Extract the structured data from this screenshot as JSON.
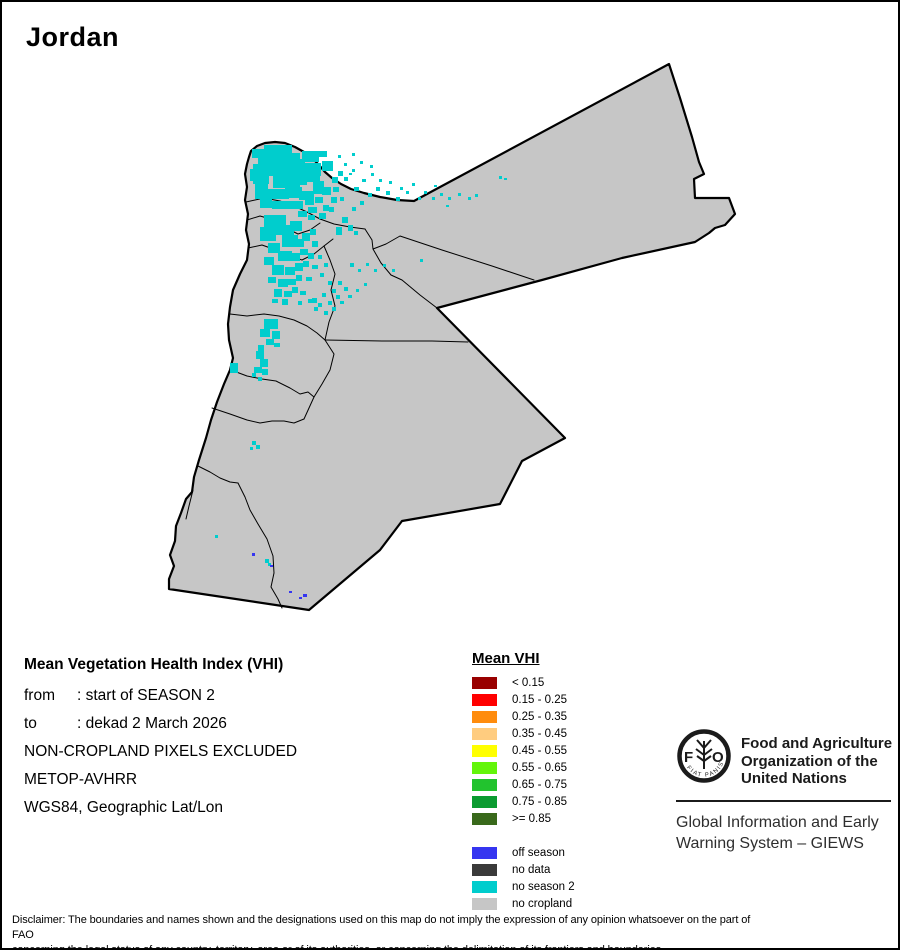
{
  "title": "Jordan",
  "colors": {
    "background": "#FFFFFF",
    "frame": "#000000",
    "land_no_cropland": "#C6C6C6",
    "boundary": "#000000"
  },
  "info": {
    "title": "Mean Vegetation Health Index (VHI)",
    "rows": [
      {
        "label": "from",
        "value": ": start of SEASON 2"
      },
      {
        "label": "to",
        "value": ": dekad 2 March 2026"
      }
    ],
    "lines": [
      "NON-CROPLAND PIXELS EXCLUDED",
      "METOP-AVHRR",
      "WGS84, Geographic Lat/Lon"
    ]
  },
  "legend": {
    "title": "Mean VHI",
    "vhi_classes": [
      {
        "label": "< 0.15",
        "color": "#990000"
      },
      {
        "label": "0.15 - 0.25",
        "color": "#FF0000"
      },
      {
        "label": "0.25 - 0.35",
        "color": "#FF8C0D"
      },
      {
        "label": "0.35 - 0.45",
        "color": "#FFCC7F"
      },
      {
        "label": "0.45 - 0.55",
        "color": "#FFFF00"
      },
      {
        "label": "0.55 - 0.65",
        "color": "#63F50A"
      },
      {
        "label": "0.65 - 0.75",
        "color": "#22C32E"
      },
      {
        "label": "0.75 - 0.85",
        "color": "#0B9B30"
      },
      {
        "label": ">= 0.85",
        "color": "#39691B"
      }
    ],
    "status_classes": [
      {
        "label": "off season",
        "color": "#3535F0"
      },
      {
        "label": "no data",
        "color": "#3A3A3A"
      },
      {
        "label": "no season 2",
        "color": "#00CDCD"
      },
      {
        "label": "no cropland",
        "color": "#C6C6C6"
      }
    ]
  },
  "fao": {
    "org_lines": [
      "Food and Agriculture",
      "Organization of the",
      "United Nations"
    ],
    "giews_lines": [
      "Global Information and Early",
      "Warning System – GIEWS"
    ],
    "logo": {
      "letter_f": "F",
      "letter_o": "O",
      "motto": "FIAT PANIS"
    }
  },
  "disclaimer": {
    "lines": [
      "Disclaimer: The boundaries and names shown and the designations used on this map do not imply the expression of any opinion whatsoever on the part of FAO",
      "concerning the legal status of any country, territory, area or of its authorities, or concerning the delimitation of its frontiers and boundaries."
    ]
  }
}
